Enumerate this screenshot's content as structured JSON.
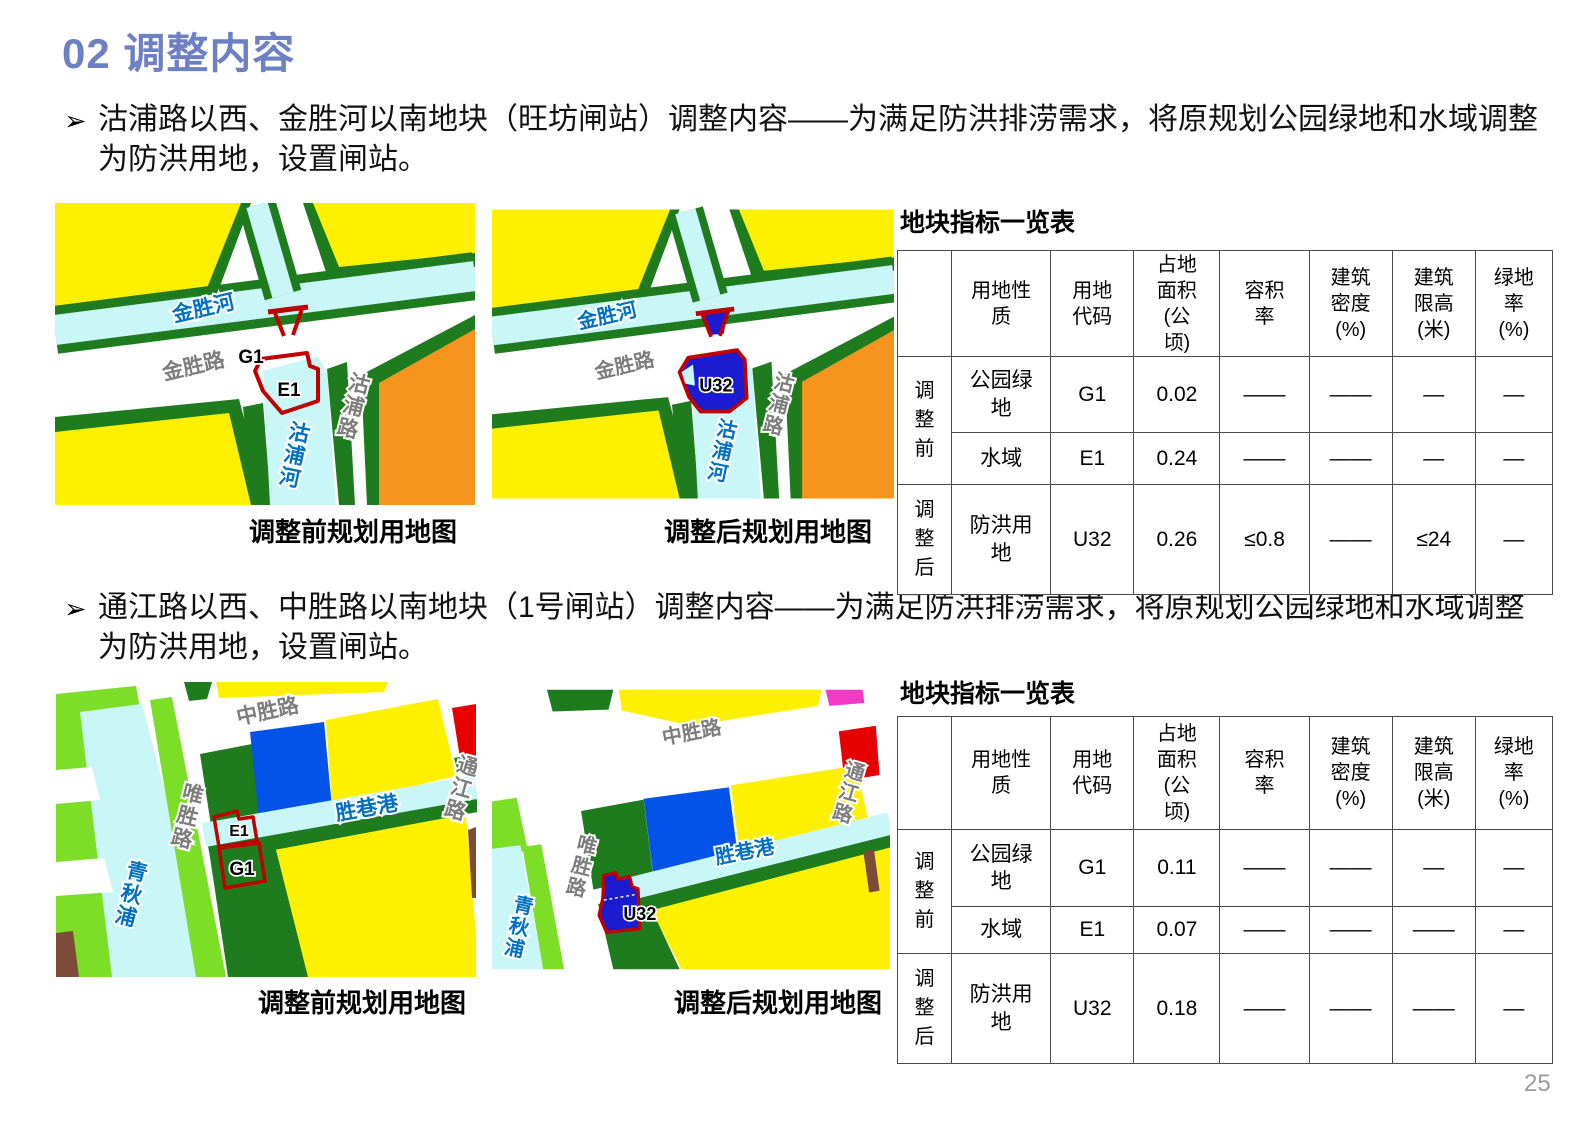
{
  "page": {
    "title": "02 调整内容",
    "page_number": "25",
    "accent_color": "#6d80c3"
  },
  "bullets": [
    {
      "marker": "➢",
      "text": "沽浦路以西、金胜河以南地块（旺坊闸站）调整内容——为满足防洪排涝需求，将原规划公园绿地和水域调整为防洪用地，设置闸站。"
    },
    {
      "marker": "➢",
      "text": "通江路以西、中胜路以南地块（1号闸站）调整内容——为满足防洪排涝需求，将原规划公园绿地和水域调整为防洪用地，设置闸站。"
    }
  ],
  "colors": {
    "land_yellow": "#FFF000",
    "land_green_dark": "#1E7C1E",
    "land_green_bright": "#7CDE26",
    "water_cyan": "#C9F6F7",
    "land_orange": "#F7941E",
    "land_blue": "#0353E9",
    "u32_blue": "#1B1BD0",
    "parcel_red": "#C00000",
    "land_red": "#E60000",
    "land_magenta": "#F23BC4",
    "land_brown": "#7E4B38"
  },
  "maps": [
    {
      "caption": "调整前规划用地图",
      "labels": {
        "river_h": "金胜河",
        "road_h": "金胜路",
        "road_v": "沽浦路",
        "river_v": "沽浦河",
        "code_g1": "G1",
        "code_e1": "E1"
      }
    },
    {
      "caption": "调整后规划用地图",
      "labels": {
        "river_h": "金胜河",
        "road_h": "金胜路",
        "road_v": "沽浦路",
        "river_v": "沽浦河",
        "code_u32": "U32"
      }
    },
    {
      "caption": "调整前规划用地图",
      "labels": {
        "road_top": "中胜路",
        "road_left": "唯胜路",
        "road_right": "通江路",
        "river_left": "青秋浦",
        "river_h": "胜巷港",
        "code_e1": "E1",
        "code_g1": "G1"
      }
    },
    {
      "caption": "调整后规划用地图",
      "labels": {
        "road_top": "中胜路",
        "road_left": "唯胜路",
        "road_right": "通江路",
        "river_left": "青秋浦",
        "river_h": "胜巷港",
        "code_u32": "U32"
      }
    }
  ],
  "tables": [
    {
      "title": "地块指标一览表",
      "headers": [
        "",
        "用地性质",
        "用地代码",
        "占地面积(公顷)",
        "容积率",
        "建筑密度(%)",
        "建筑限高(米)",
        "绿地率(%)"
      ],
      "row_groups": [
        {
          "label": "调整前",
          "rows": [
            [
              "公园绿地",
              "G1",
              "0.02",
              "——",
              "——",
              "—",
              "—"
            ],
            [
              "水域",
              "E1",
              "0.24",
              "——",
              "——",
              "—",
              "—"
            ]
          ]
        },
        {
          "label": "调整后",
          "rows": [
            [
              "防洪用地",
              "U32",
              "0.26",
              "≤0.8",
              "——",
              "≤24",
              "—"
            ]
          ]
        }
      ]
    },
    {
      "title": "地块指标一览表",
      "headers": [
        "",
        "用地性质",
        "用地代码",
        "占地面积(公顷)",
        "容积率",
        "建筑密度(%)",
        "建筑限高(米)",
        "绿地率(%)"
      ],
      "row_groups": [
        {
          "label": "调整前",
          "rows": [
            [
              "公园绿地",
              "G1",
              "0.11",
              "——",
              "——",
              "—",
              "—"
            ],
            [
              "水域",
              "E1",
              "0.07",
              "——",
              "——",
              "——",
              "—"
            ]
          ]
        },
        {
          "label": "调整后",
          "rows": [
            [
              "防洪用地",
              "U32",
              "0.18",
              "——",
              "——",
              "——",
              "—"
            ]
          ]
        }
      ]
    }
  ]
}
